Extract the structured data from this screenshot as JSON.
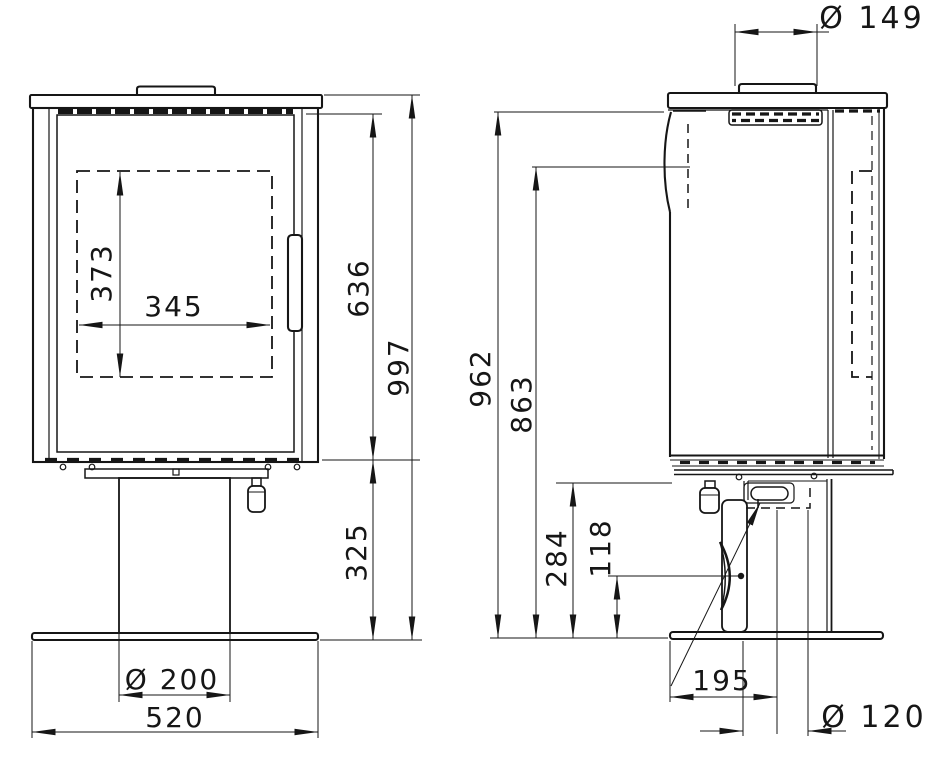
{
  "title": "Pedestal stove dimensional drawing, front and side views",
  "units": "mm",
  "colors": {
    "line": "#161616",
    "background": "#ffffff"
  },
  "views": {
    "front": {
      "glass_height_mm": "373",
      "glass_width_mm": "345",
      "body_height_mm": "636",
      "total_height_mm": "997",
      "pedestal_height_mm": "325",
      "column_diameter_mm": "Ø 200",
      "base_width_mm": "520"
    },
    "side": {
      "flue_collar_diameter_mm": "Ø 149",
      "body_top_height_mm": "962",
      "rear_outlet_height_mm": "863",
      "underbody_height_mm": "284",
      "lever_pivot_height_mm": "118",
      "flue_center_offset_mm": "195",
      "rear_flue_diameter_mm": "Ø 120"
    }
  }
}
